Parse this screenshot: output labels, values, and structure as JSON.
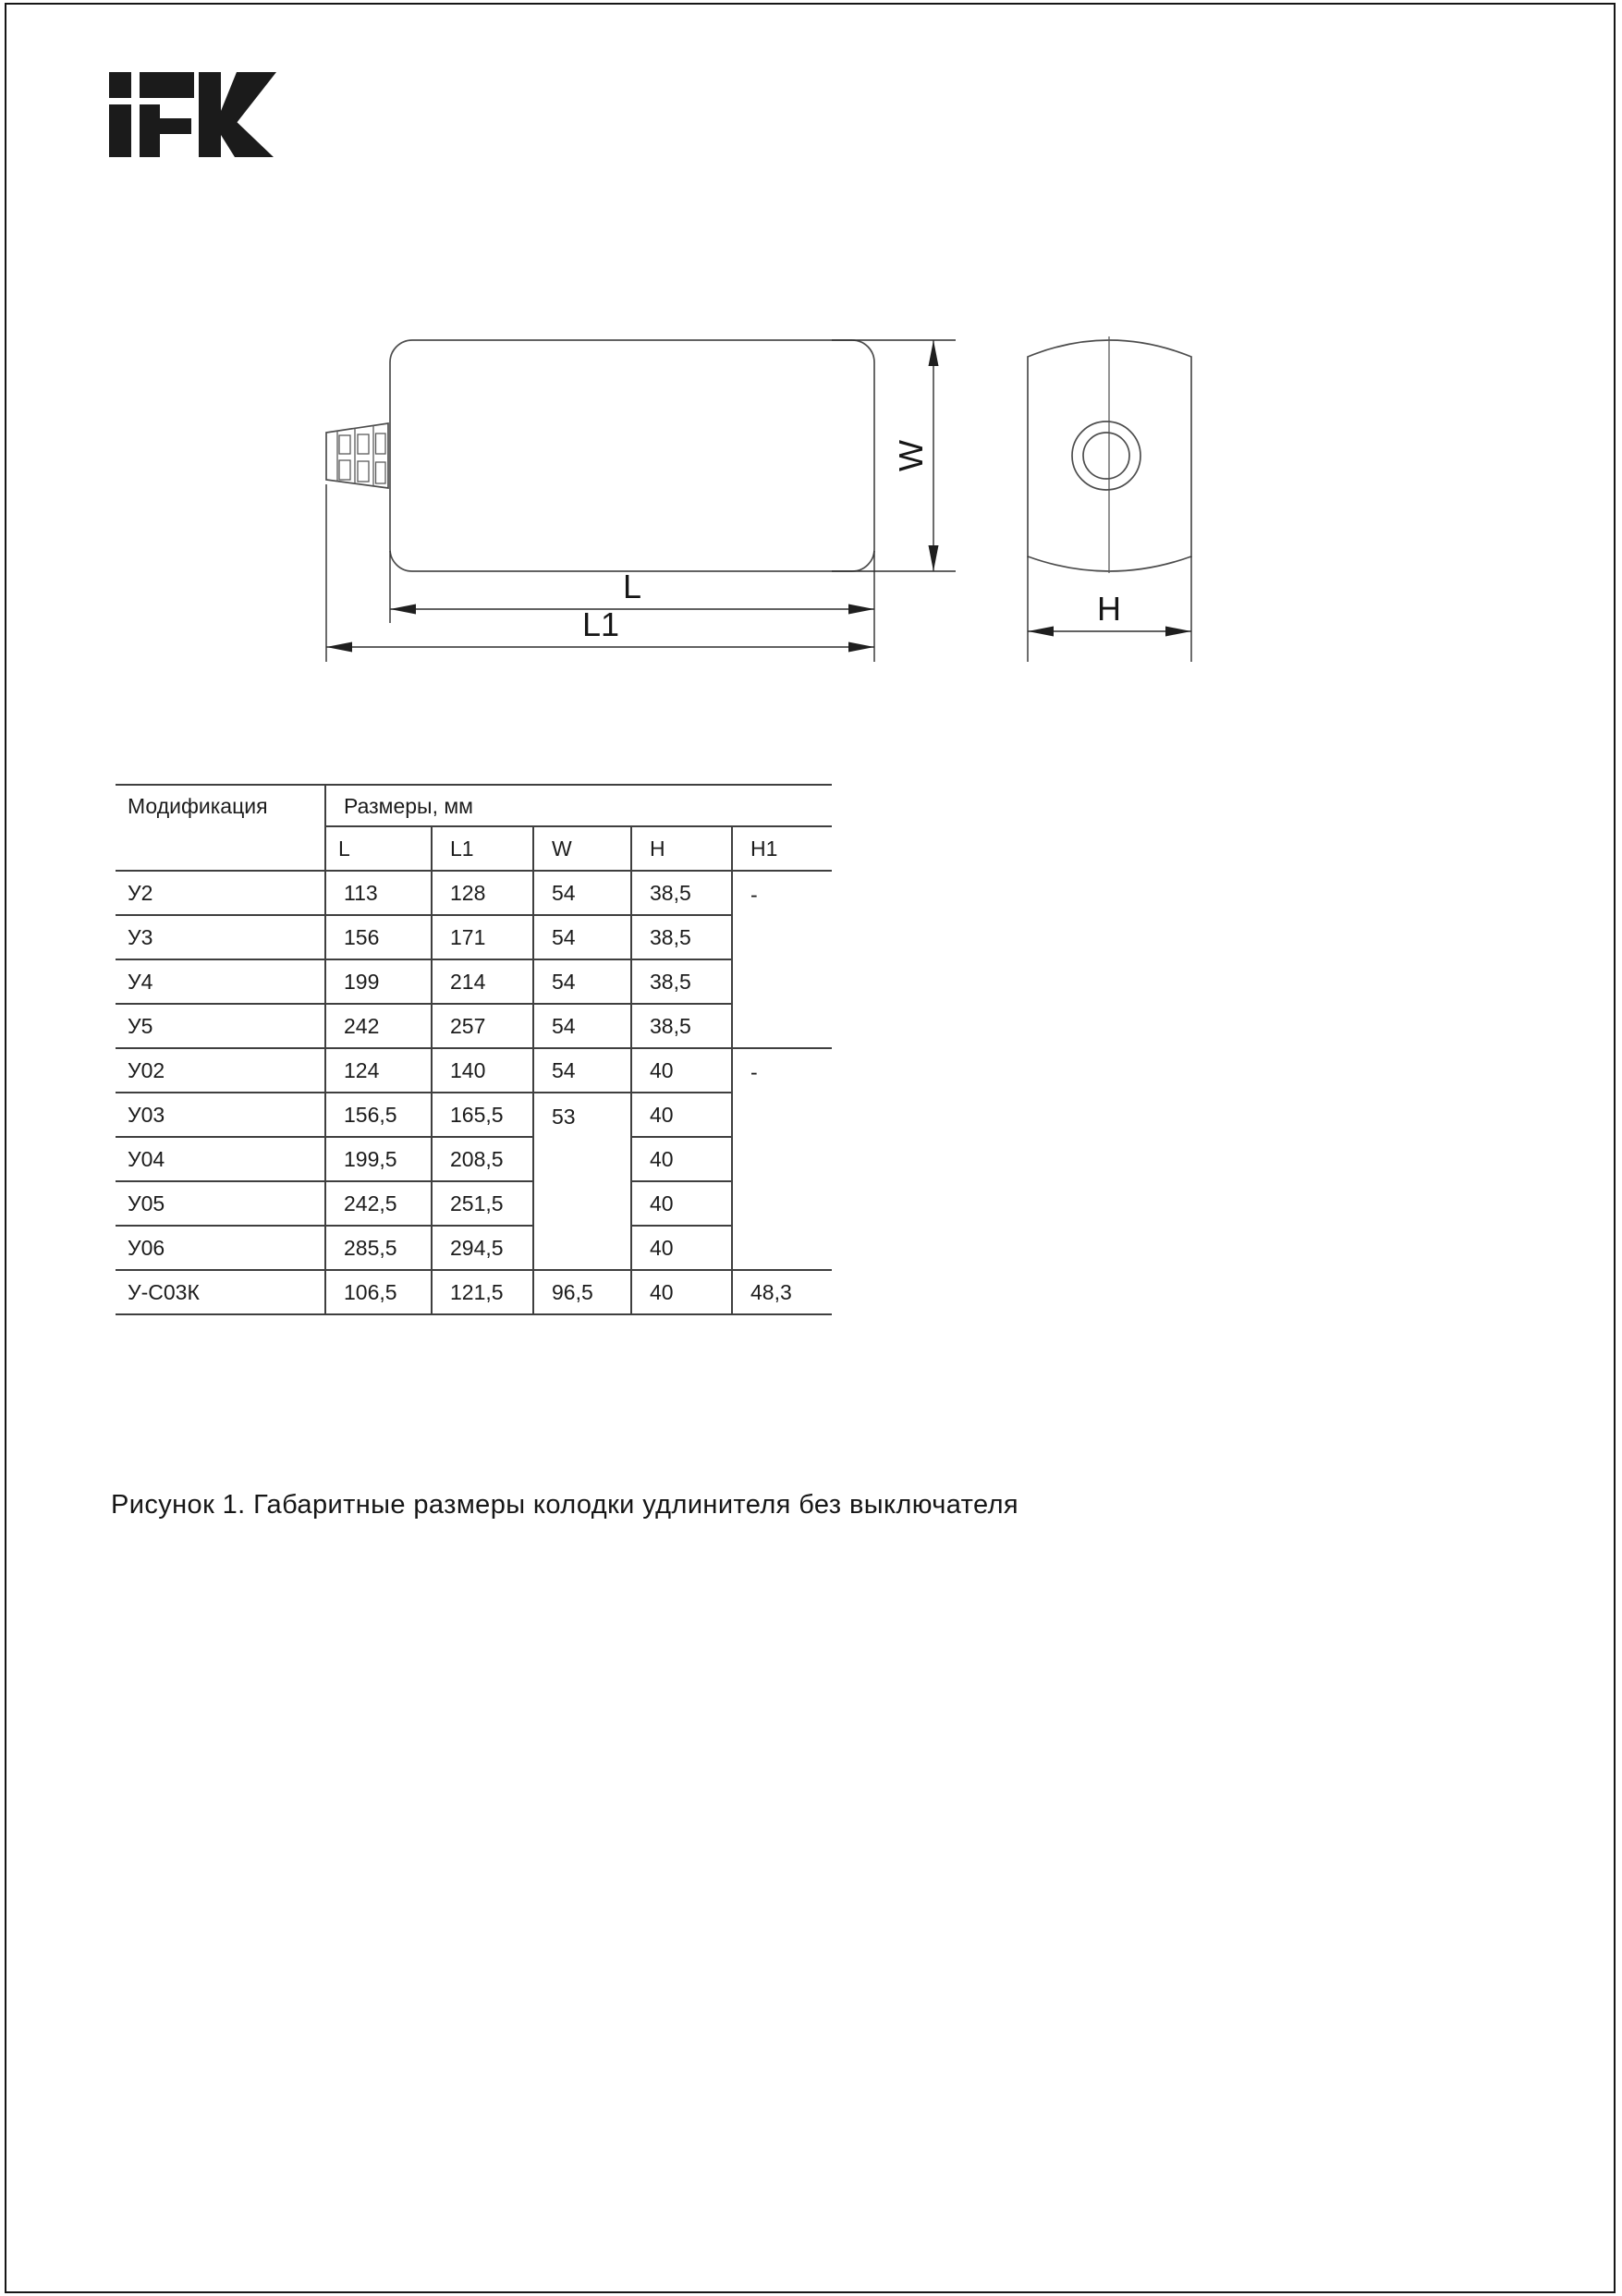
{
  "logo": {
    "brand": "IEK"
  },
  "figure": {
    "labels": {
      "l": "L",
      "l1": "L1",
      "w": "W",
      "h": "H"
    },
    "caption": "Рисунок 1. Габаритные размеры колодки удлинителя без выключателя"
  },
  "table": {
    "header": {
      "modification": "Модификация",
      "dimensions_group": "Размеры, мм",
      "columns": [
        "L",
        "L1",
        "W",
        "H",
        "H1"
      ]
    },
    "rows": [
      {
        "mod": "У2",
        "l": "113",
        "l1": "128",
        "w": "54",
        "h": "38,5",
        "h1": "-"
      },
      {
        "mod": "У3",
        "l": "156",
        "l1": "171",
        "w": "54",
        "h": "38,5"
      },
      {
        "mod": "У4",
        "l": "199",
        "l1": "214",
        "w": "54",
        "h": "38,5"
      },
      {
        "mod": "У5",
        "l": "242",
        "l1": "257",
        "w": "54",
        "h": "38,5"
      },
      {
        "mod": "У02",
        "l": "124",
        "l1": "140",
        "w": "54",
        "h": "40",
        "h1": "-"
      },
      {
        "mod": "У03",
        "l": "156,5",
        "l1": "165,5",
        "w": "53",
        "h": "40"
      },
      {
        "mod": "У04",
        "l": "199,5",
        "l1": "208,5",
        "h": "40"
      },
      {
        "mod": "У05",
        "l": "242,5",
        "l1": "251,5",
        "h": "40"
      },
      {
        "mod": "У06",
        "l": "285,5",
        "l1": "294,5",
        "h": "40"
      },
      {
        "mod": "У-С03К",
        "l": "106,5",
        "l1": "121,5",
        "w": "96,5",
        "h": "40",
        "h1": "48,3"
      }
    ]
  },
  "colors": {
    "line": "#4d4d4d",
    "dimension_line": "#2e2e2e",
    "text": "#161616",
    "table_border": "#3f3f3f"
  }
}
